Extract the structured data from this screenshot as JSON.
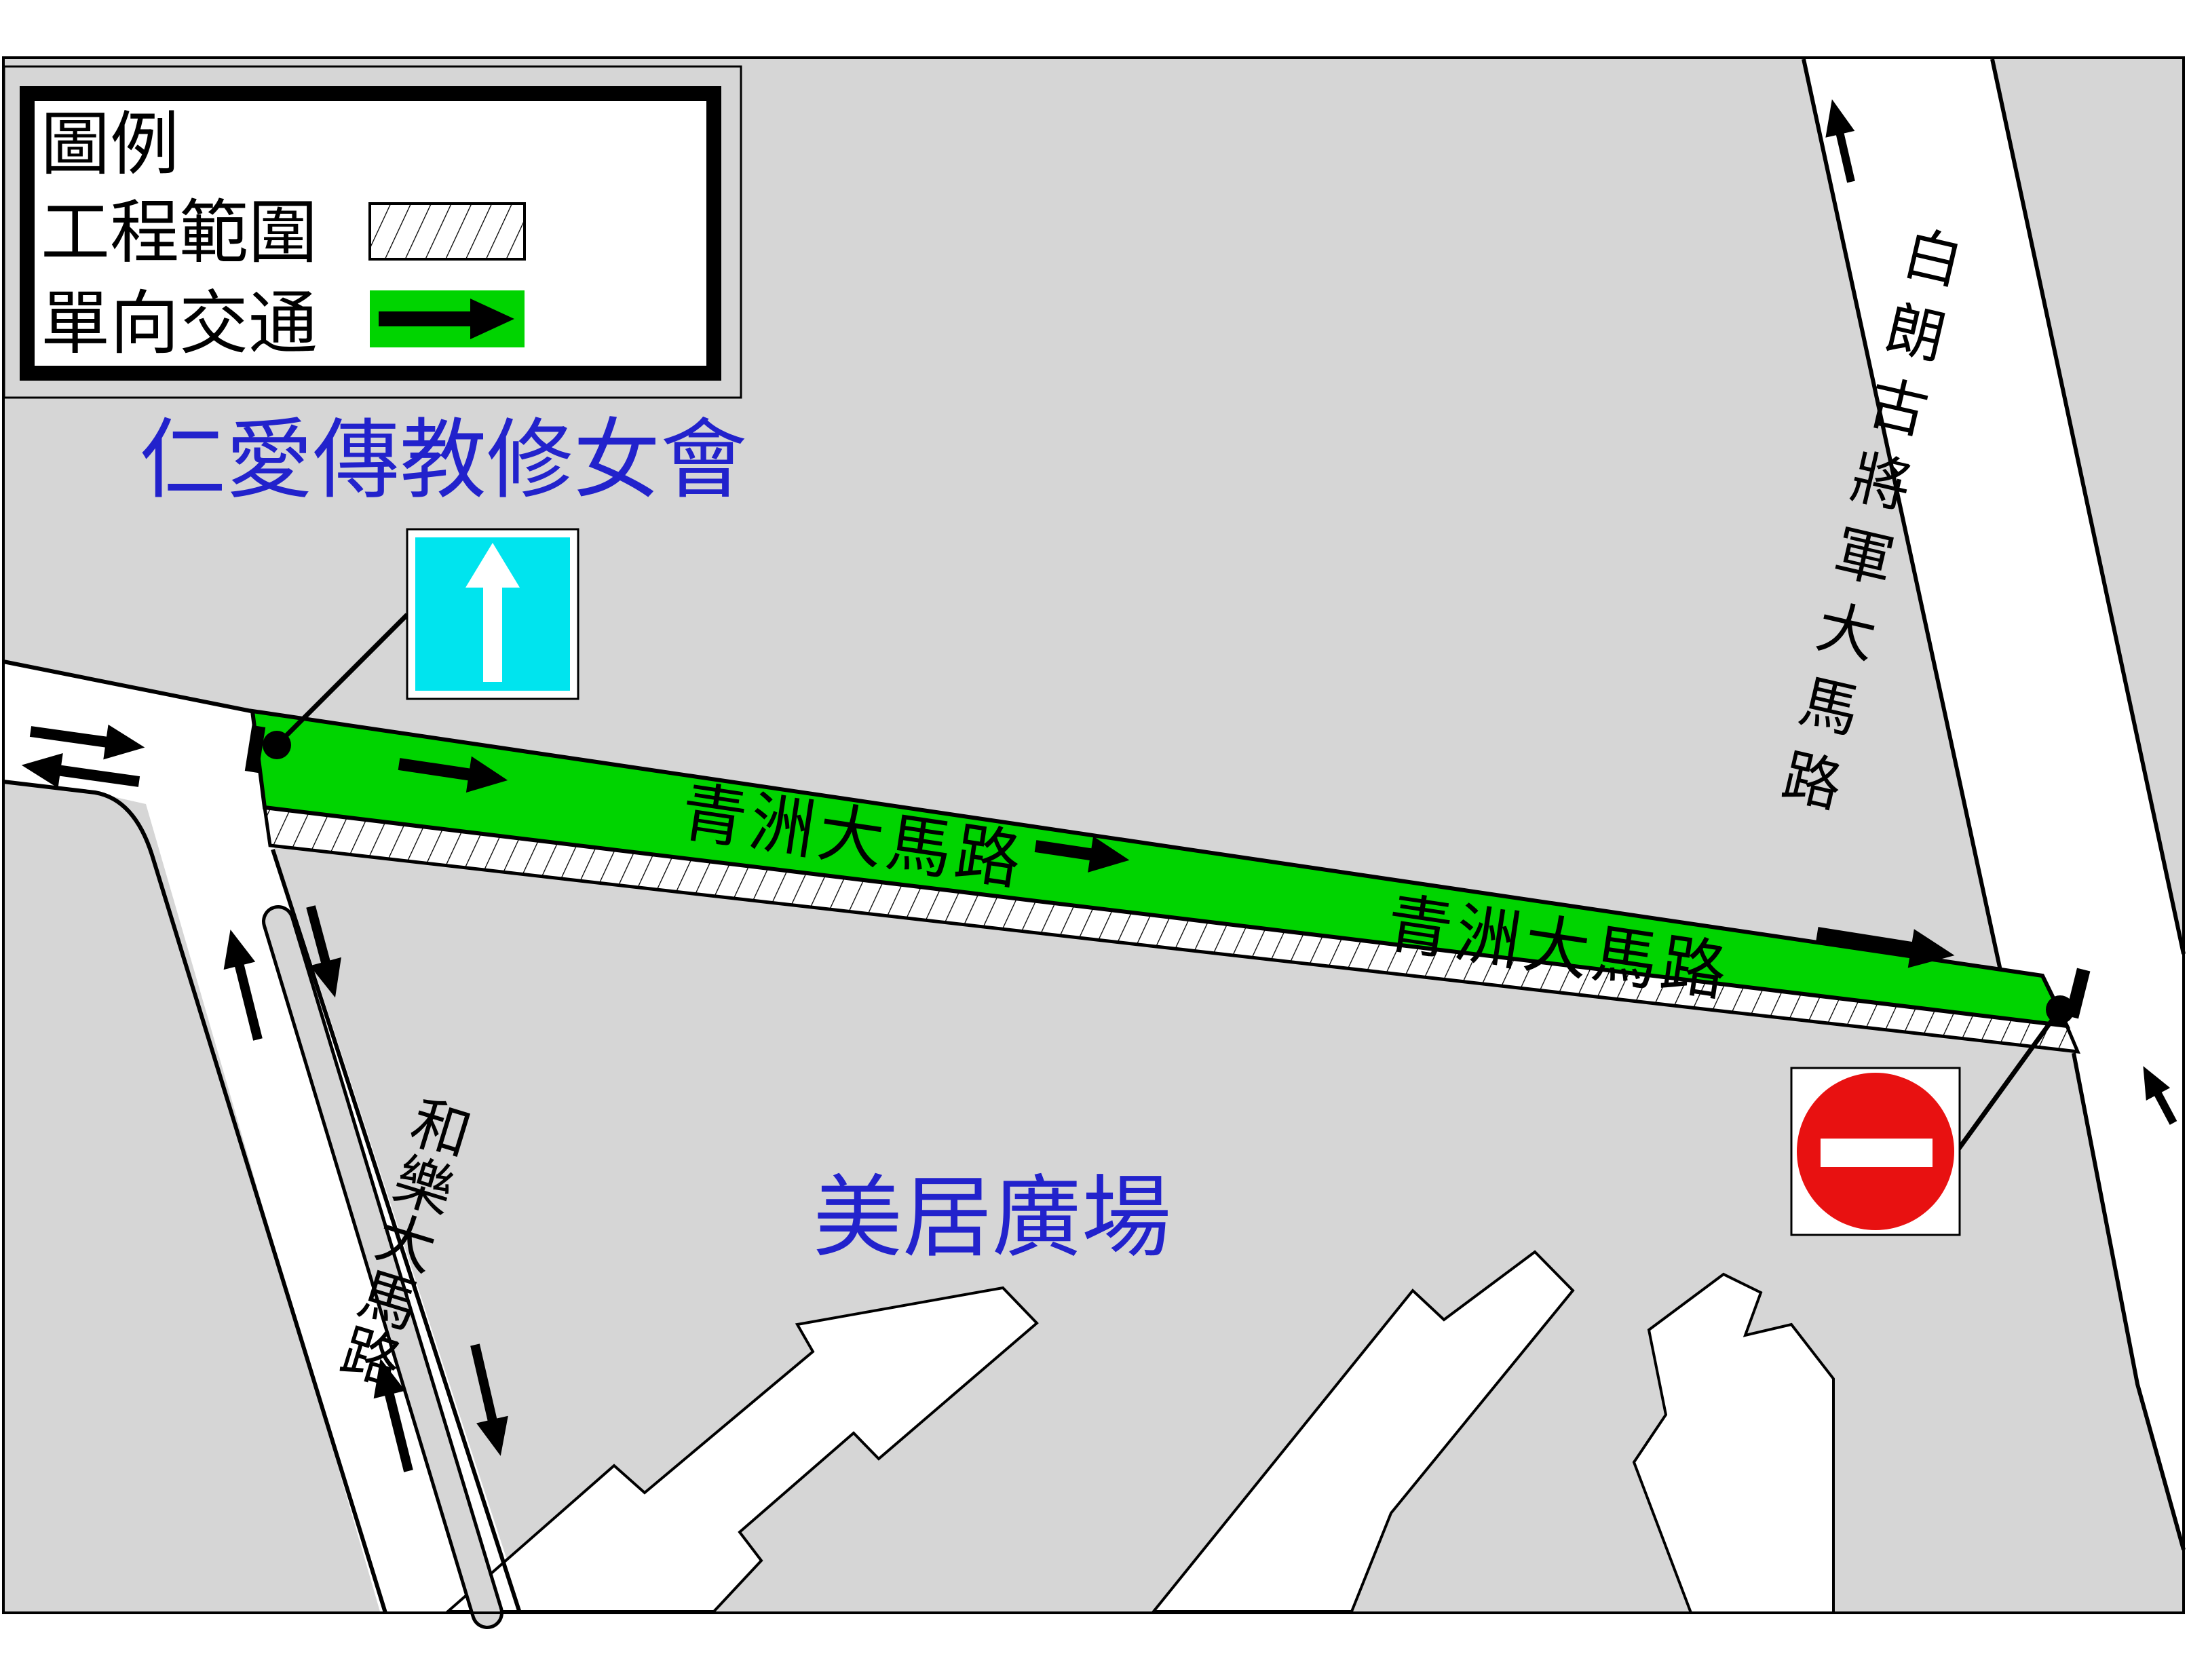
{
  "legend": {
    "title": "圖例",
    "works_area_label": "工程範圍",
    "one_way_label": "單向交通"
  },
  "place_labels": {
    "missionaries_of_charity": "仁愛傳教修女會",
    "mei_kui_plaza": "美居廣場"
  },
  "road_labels": {
    "qingzhou_west": "青洲大馬路",
    "qingzhou_east": "青洲大馬路",
    "ho_lok": "和樂大馬路",
    "castelo_branco": "白朗古將軍大馬路"
  },
  "signs": {
    "ahead_only": "ahead-only-sign",
    "no_entry": "no-entry-sign"
  },
  "colors": {
    "map_gray": "#d6d6d6",
    "one_way_green": "#00d400",
    "sign_cyan": "#00e4ee",
    "sign_red": "#e81111",
    "label_blue": "#2222cc",
    "road_white": "#ffffff",
    "line_black": "#000000"
  }
}
